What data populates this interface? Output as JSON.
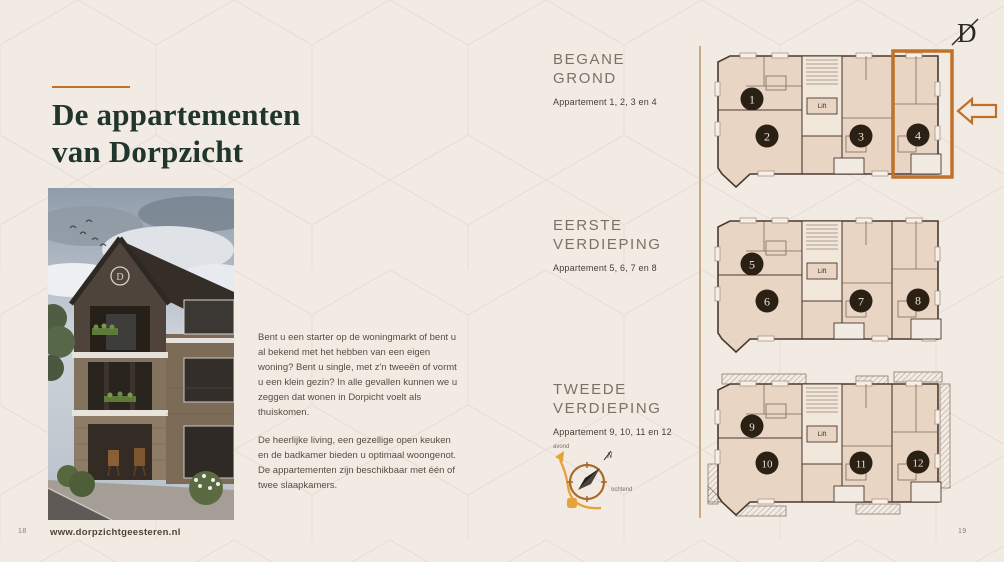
{
  "colors": {
    "background": "#f2ebe4",
    "brand_dark_green": "#20352c",
    "accent_orange": "#c0722a",
    "compass_amber": "#e4a33c",
    "plan_fill": "#e9d5c4",
    "badge_fill": "#2b2014"
  },
  "left_page": {
    "title": {
      "line1_regular": "De ",
      "line1_bold": "appartementen",
      "line2": "van Dorpzicht"
    },
    "paragraphs": [
      "Bent u een starter op de woningmarkt of bent u al bekend met het hebben van een eigen woning? Bent u single, met z'n tweeën of vormt u een klein gezin? In alle gevallen kunnen we u zeggen dat wonen in Dorpicht voelt als thuiskomen.",
      "De heerlijke living, een gezellige open keuken en de badkamer bieden u optimaal woongenot. De appartementen zijn beschikbaar met één of twee slaapkamers."
    ],
    "footer": {
      "page_number": "18",
      "website": "www.dorpzichtgeesteren.nl"
    }
  },
  "right_page": {
    "logo_letter": "D",
    "sections": [
      {
        "title_line1": "BEGANE",
        "title_line2": "GROND",
        "subtitle": "Appartement 1, 2, 3 en 4"
      },
      {
        "title_line1": "EERSTE",
        "title_line2": "VERDIEPING",
        "subtitle": "Appartement 5, 6, 7 en 8"
      },
      {
        "title_line1": "TWEEDE",
        "title_line2": "VERDIEPING",
        "subtitle": "Appartement 9, 10, 11 en 12"
      }
    ],
    "compass": {
      "evening_label": "avond",
      "morning_label": "ochtend",
      "north_label": "N"
    },
    "plans": [
      {
        "lift_label": "Lift",
        "units": [
          "1",
          "2",
          "3",
          "4"
        ],
        "highlighted_unit": "4"
      },
      {
        "lift_label": "Lift",
        "units": [
          "5",
          "6",
          "7",
          "8"
        ],
        "highlighted_unit": ""
      },
      {
        "lift_label": "Lift",
        "units": [
          "9",
          "10",
          "11",
          "12"
        ],
        "highlighted_unit": ""
      }
    ],
    "page_number": "19"
  }
}
